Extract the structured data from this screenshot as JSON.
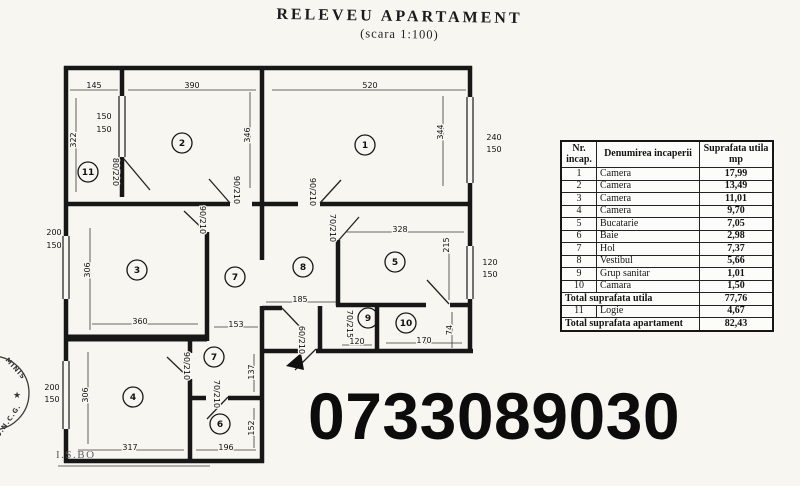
{
  "title": {
    "main": "RELEVEU  APARTAMENT",
    "sub": "(scara 1:100)"
  },
  "phone": "0733089030",
  "watermark": {
    "stamp_top": "MINIS",
    "stamp_bottom": "O.N.C.G.",
    "star": "★",
    "corner_mark": "I.S.BO"
  },
  "table": {
    "col_headers": [
      "Nr.\nincap.",
      "Denumirea incaperii",
      "Suprafata utila\nmp"
    ],
    "rows": [
      {
        "nr": "1",
        "name": "Camera",
        "mp": "17,99"
      },
      {
        "nr": "2",
        "name": "Camera",
        "mp": "13,49"
      },
      {
        "nr": "3",
        "name": "Camera",
        "mp": "11,01"
      },
      {
        "nr": "4",
        "name": "Camera",
        "mp": "9,70"
      },
      {
        "nr": "5",
        "name": "Bucatarie",
        "mp": "7,05"
      },
      {
        "nr": "6",
        "name": "Baie",
        "mp": "2,98"
      },
      {
        "nr": "7",
        "name": "Hol",
        "mp": "7,37"
      },
      {
        "nr": "8",
        "name": "Vestibul",
        "mp": "5,66"
      },
      {
        "nr": "9",
        "name": "Grup sanitar",
        "mp": "1,01"
      },
      {
        "nr": "10",
        "name": "Camara",
        "mp": "1,50"
      }
    ],
    "total_utila": {
      "label": "Total suprafata utila",
      "mp": "77,76"
    },
    "logie": {
      "nr": "11",
      "name": "Logie",
      "mp": "4,67"
    },
    "total_apartament": {
      "label": "Total suprafata apartament",
      "mp": "82,43"
    }
  },
  "plan": {
    "rooms": [
      {
        "nr": "1",
        "x": 365,
        "y": 145
      },
      {
        "nr": "2",
        "x": 182,
        "y": 143
      },
      {
        "nr": "3",
        "x": 137,
        "y": 270
      },
      {
        "nr": "4",
        "x": 133,
        "y": 397
      },
      {
        "nr": "5",
        "x": 395,
        "y": 262
      },
      {
        "nr": "6",
        "x": 220,
        "y": 424
      },
      {
        "nr": "7",
        "x": 235,
        "y": 277
      },
      {
        "nr": "7",
        "x": 214,
        "y": 357
      },
      {
        "nr": "8",
        "x": 303,
        "y": 267
      },
      {
        "nr": "9",
        "x": 368,
        "y": 318
      },
      {
        "nr": "10",
        "x": 406,
        "y": 323
      },
      {
        "nr": "11",
        "x": 88,
        "y": 172
      }
    ],
    "dims": [
      {
        "t": "145",
        "x": 94,
        "y": 88,
        "r": 0
      },
      {
        "t": "390",
        "x": 192,
        "y": 88,
        "r": 0
      },
      {
        "t": "520",
        "x": 370,
        "y": 88,
        "r": 0
      },
      {
        "t": "322",
        "x": 76,
        "y": 140,
        "r": -90
      },
      {
        "t": "150",
        "x": 104,
        "y": 119,
        "r": 0
      },
      {
        "t": "150",
        "x": 104,
        "y": 132,
        "r": 0
      },
      {
        "t": "346",
        "x": 250,
        "y": 135,
        "r": -90
      },
      {
        "t": "344",
        "x": 443,
        "y": 132,
        "r": -90
      },
      {
        "t": "240",
        "x": 494,
        "y": 140,
        "r": 0
      },
      {
        "t": "150",
        "x": 494,
        "y": 152,
        "r": 0
      },
      {
        "t": "80/220",
        "x": 113,
        "y": 172,
        "r": 90
      },
      {
        "t": "90/210",
        "x": 234,
        "y": 190,
        "r": 90
      },
      {
        "t": "90/210",
        "x": 310,
        "y": 192,
        "r": 90
      },
      {
        "t": "70/210",
        "x": 330,
        "y": 228,
        "r": 90
      },
      {
        "t": "90/210",
        "x": 200,
        "y": 220,
        "r": 90
      },
      {
        "t": "328",
        "x": 400,
        "y": 232,
        "r": 0
      },
      {
        "t": "215",
        "x": 449,
        "y": 245,
        "r": -90
      },
      {
        "t": "120",
        "x": 490,
        "y": 265,
        "r": 0
      },
      {
        "t": "150",
        "x": 490,
        "y": 277,
        "r": 0
      },
      {
        "t": "200",
        "x": 54,
        "y": 235,
        "r": 0
      },
      {
        "t": "150",
        "x": 54,
        "y": 248,
        "r": 0
      },
      {
        "t": "306",
        "x": 90,
        "y": 270,
        "r": -90
      },
      {
        "t": "360",
        "x": 140,
        "y": 324,
        "r": 0
      },
      {
        "t": "153",
        "x": 236,
        "y": 327,
        "r": 0
      },
      {
        "t": "185",
        "x": 300,
        "y": 302,
        "r": 0
      },
      {
        "t": "70/215",
        "x": 347,
        "y": 324,
        "r": 90
      },
      {
        "t": "120",
        "x": 357,
        "y": 344,
        "r": 0
      },
      {
        "t": "170",
        "x": 424,
        "y": 343,
        "r": 0
      },
      {
        "t": "74",
        "x": 452,
        "y": 330,
        "r": -90
      },
      {
        "t": "60/210",
        "x": 299,
        "y": 340,
        "r": 90
      },
      {
        "t": "137",
        "x": 254,
        "y": 372,
        "r": -90
      },
      {
        "t": "90/210",
        "x": 184,
        "y": 366,
        "r": 90
      },
      {
        "t": "70/210",
        "x": 214,
        "y": 394,
        "r": 90
      },
      {
        "t": "200",
        "x": 52,
        "y": 390,
        "r": 0
      },
      {
        "t": "150",
        "x": 52,
        "y": 402,
        "r": 0
      },
      {
        "t": "306",
        "x": 88,
        "y": 395,
        "r": -90
      },
      {
        "t": "317",
        "x": 130,
        "y": 450,
        "r": 0
      },
      {
        "t": "196",
        "x": 226,
        "y": 450,
        "r": 0
      },
      {
        "t": "152",
        "x": 254,
        "y": 428,
        "r": -90
      }
    ]
  }
}
